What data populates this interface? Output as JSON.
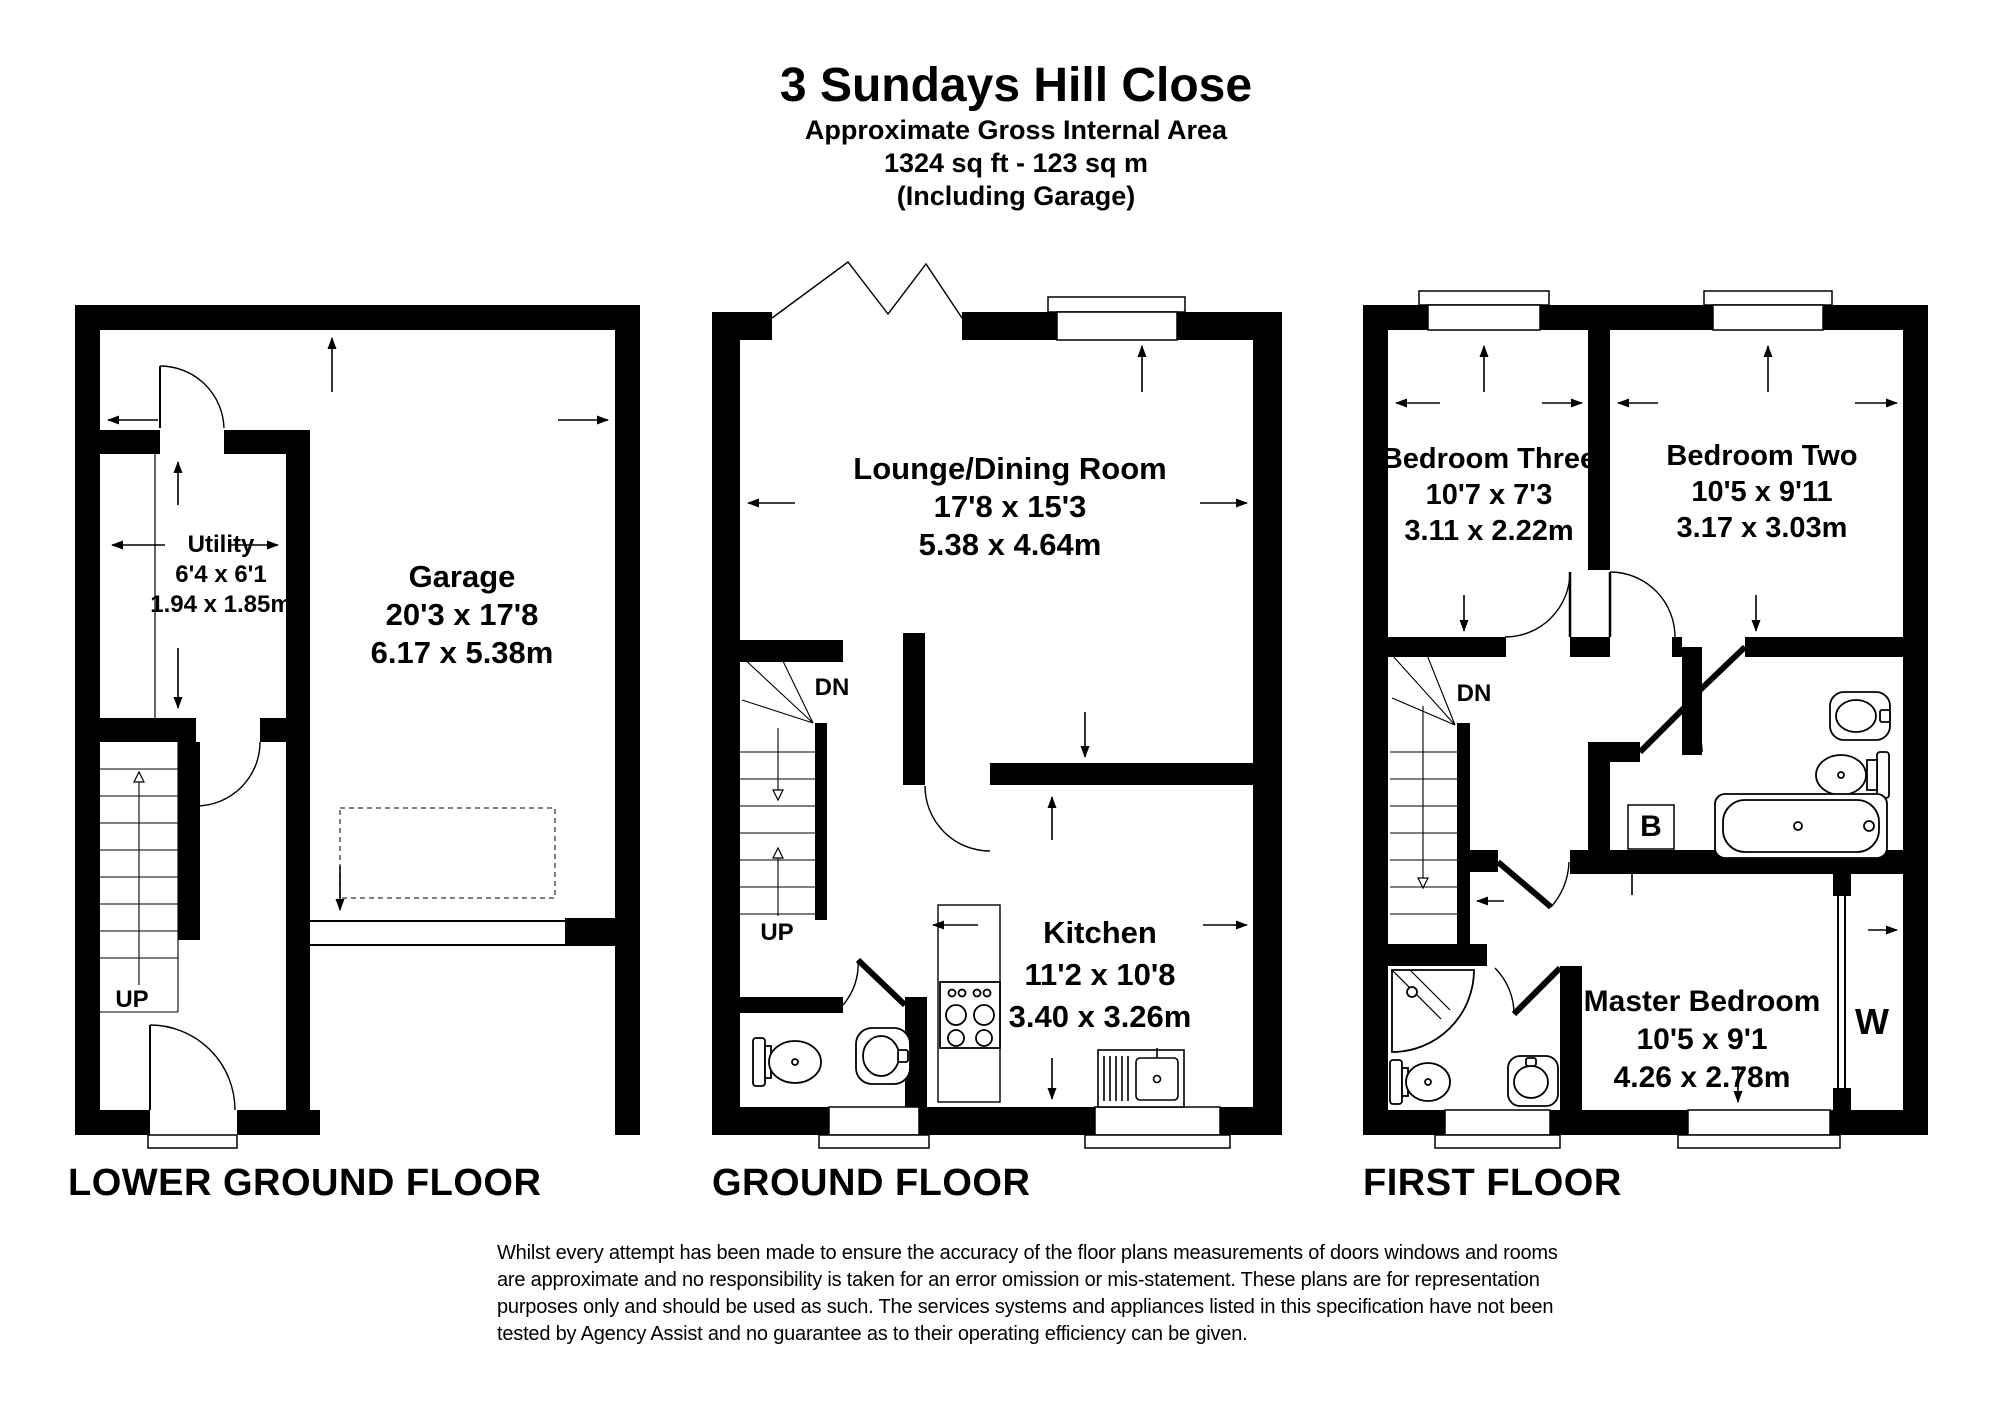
{
  "header": {
    "title": "3 Sundays Hill Close",
    "subtitle_line1": "Approximate Gross Internal Area",
    "subtitle_line2": "1324 sq ft - 123 sq m",
    "subtitle_line3": "(Including Garage)"
  },
  "floors": {
    "lower_ground": {
      "label": "LOWER GROUND FLOOR",
      "rooms": {
        "utility": {
          "name": "Utility",
          "imperial": "6'4 x 6'1",
          "metric": "1.94 x 1.85m"
        },
        "garage": {
          "name": "Garage",
          "imperial": "20'3 x 17'8",
          "metric": "6.17 x 5.38m"
        }
      },
      "stairs": {
        "up": "UP"
      }
    },
    "ground": {
      "label": "GROUND FLOOR",
      "rooms": {
        "lounge_dining": {
          "name": "Lounge/Dining Room",
          "imperial": "17'8 x 15'3",
          "metric": "5.38 x 4.64m"
        },
        "kitchen": {
          "name": "Kitchen",
          "imperial": "11'2 x 10'8",
          "metric": "3.40 x 3.26m"
        }
      },
      "stairs": {
        "up": "UP",
        "down": "DN"
      }
    },
    "first": {
      "label": "FIRST FLOOR",
      "rooms": {
        "bedroom_three": {
          "name": "Bedroom Three",
          "imperial": "10'7 x 7'3",
          "metric": "3.11 x 2.22m"
        },
        "bedroom_two": {
          "name": "Bedroom Two",
          "imperial": "10'5 x 9'11",
          "metric": "3.17 x 3.03m"
        },
        "master_bedroom": {
          "name": "Master Bedroom",
          "imperial": "10'5 x 9'1",
          "metric": "4.26 x 2.78m"
        }
      },
      "stairs": {
        "down": "DN"
      },
      "cupboards": {
        "boiler": "B",
        "wardrobe": "W"
      }
    }
  },
  "disclaimer": "Whilst every attempt has been made to ensure the accuracy of the floor plans measurements of doors windows and rooms are approximate and no responsibility is taken for an error omission or mis-statement. These plans are for representation purposes only and should be used as such. The services systems and appliances listed in this specification have not been tested by Agency Assist and no guarantee as to their operating efficiency can be given."
}
